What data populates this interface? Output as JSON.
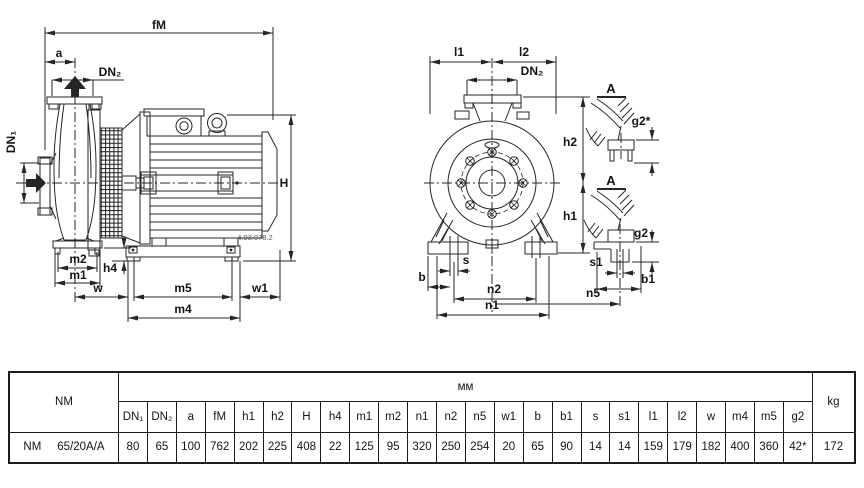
{
  "drawing": {
    "side_view": {
      "labels": {
        "fM": "fM",
        "a": "a",
        "dn2": "DN₂",
        "dn1": "DN₁",
        "H": "H",
        "h4": "h4",
        "m2": "m2",
        "m1": "m1",
        "w": "w",
        "m5": "m5",
        "w1": "w1",
        "m4": "m4"
      },
      "drawing_number": "4.93.078.2"
    },
    "front_view": {
      "labels": {
        "l1": "l1",
        "l2": "l2",
        "dn2": "DN₂",
        "h2": "h2",
        "h1": "h1",
        "s": "s",
        "b": "b",
        "n2": "n2",
        "n1": "n1"
      }
    },
    "detail_top": {
      "title": "A",
      "labels": {
        "g2": "g2*"
      }
    },
    "detail_bottom": {
      "title": "A",
      "labels": {
        "g2": "g2",
        "s1": "s1",
        "b1": "b1",
        "n5": "n5"
      }
    }
  },
  "table": {
    "model_header": "NM",
    "unit_header": "мм",
    "kg_header": "kg",
    "columns": [
      "DN₁",
      "DN₂",
      "a",
      "fM",
      "h1",
      "h2",
      "H",
      "h4",
      "m1",
      "m2",
      "n1",
      "n2",
      "n5",
      "w1",
      "b",
      "b1",
      "s",
      "s1",
      "l1",
      "l2",
      "w",
      "m4",
      "m5",
      "g2"
    ],
    "row": {
      "series": "NM",
      "size": "65/20A/A",
      "values": [
        "80",
        "65",
        "100",
        "762",
        "202",
        "225",
        "408",
        "22",
        "125",
        "95",
        "320",
        "250",
        "254",
        "20",
        "65",
        "90",
        "14",
        "14",
        "159",
        "179",
        "182",
        "400",
        "360",
        "42*"
      ],
      "kg": "172"
    }
  },
  "colors": {
    "line": "#262626",
    "text": "#141414"
  }
}
